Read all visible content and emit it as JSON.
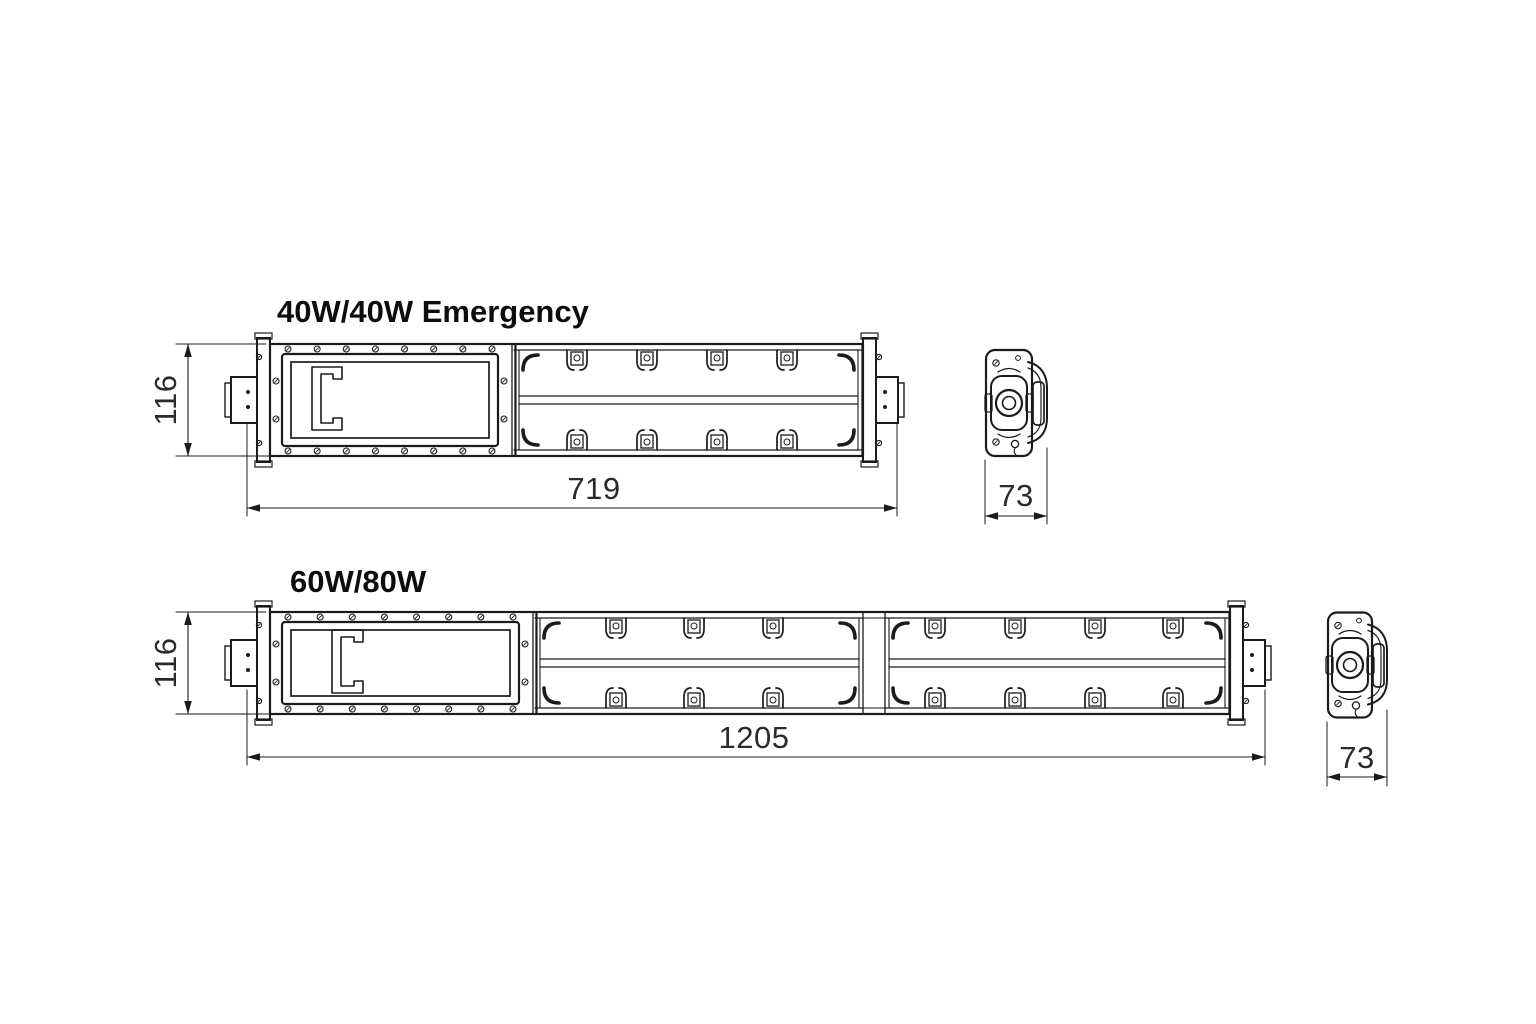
{
  "drawing": {
    "background": "#ffffff",
    "line_color": "#1b1b1b",
    "fixtures": [
      {
        "title": "40W/40W Emergency",
        "dims": {
          "height": "116",
          "length": "719",
          "depth": "73"
        }
      },
      {
        "title": "60W/80W",
        "dims": {
          "height": "116",
          "length": "1205",
          "depth": "73"
        }
      }
    ]
  }
}
